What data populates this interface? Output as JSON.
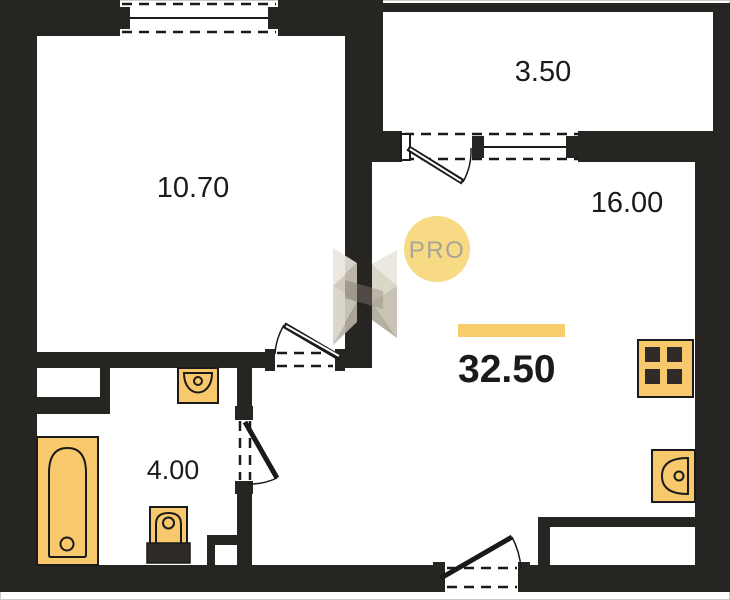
{
  "plan": {
    "total": {
      "area": "32.50"
    },
    "rooms": {
      "living": {
        "area": "10.70"
      },
      "balcony": {
        "area": "3.50"
      },
      "kitchen_living": {
        "area": "16.00"
      },
      "bathroom": {
        "area": "4.00"
      }
    },
    "watermark": {
      "badge": "PRO"
    }
  },
  "fixtures": {
    "bathtub": "bathtub-icon",
    "bathroom_sink": "sink-icon",
    "toilet": "toilet-icon",
    "stove": "stove-icon",
    "kitchen_sink": "kitchen-sink-icon"
  },
  "colors": {
    "wall": "#272522",
    "line": "#1a1a1a",
    "fixture": "#F8C86C",
    "accent": "#F7CE6B",
    "badgeBg": "#F8DA85",
    "badgeText": "#A8A397",
    "labelColor": "#1b1b1b",
    "bg": "#ffffff",
    "border": "#c9c9c9"
  }
}
